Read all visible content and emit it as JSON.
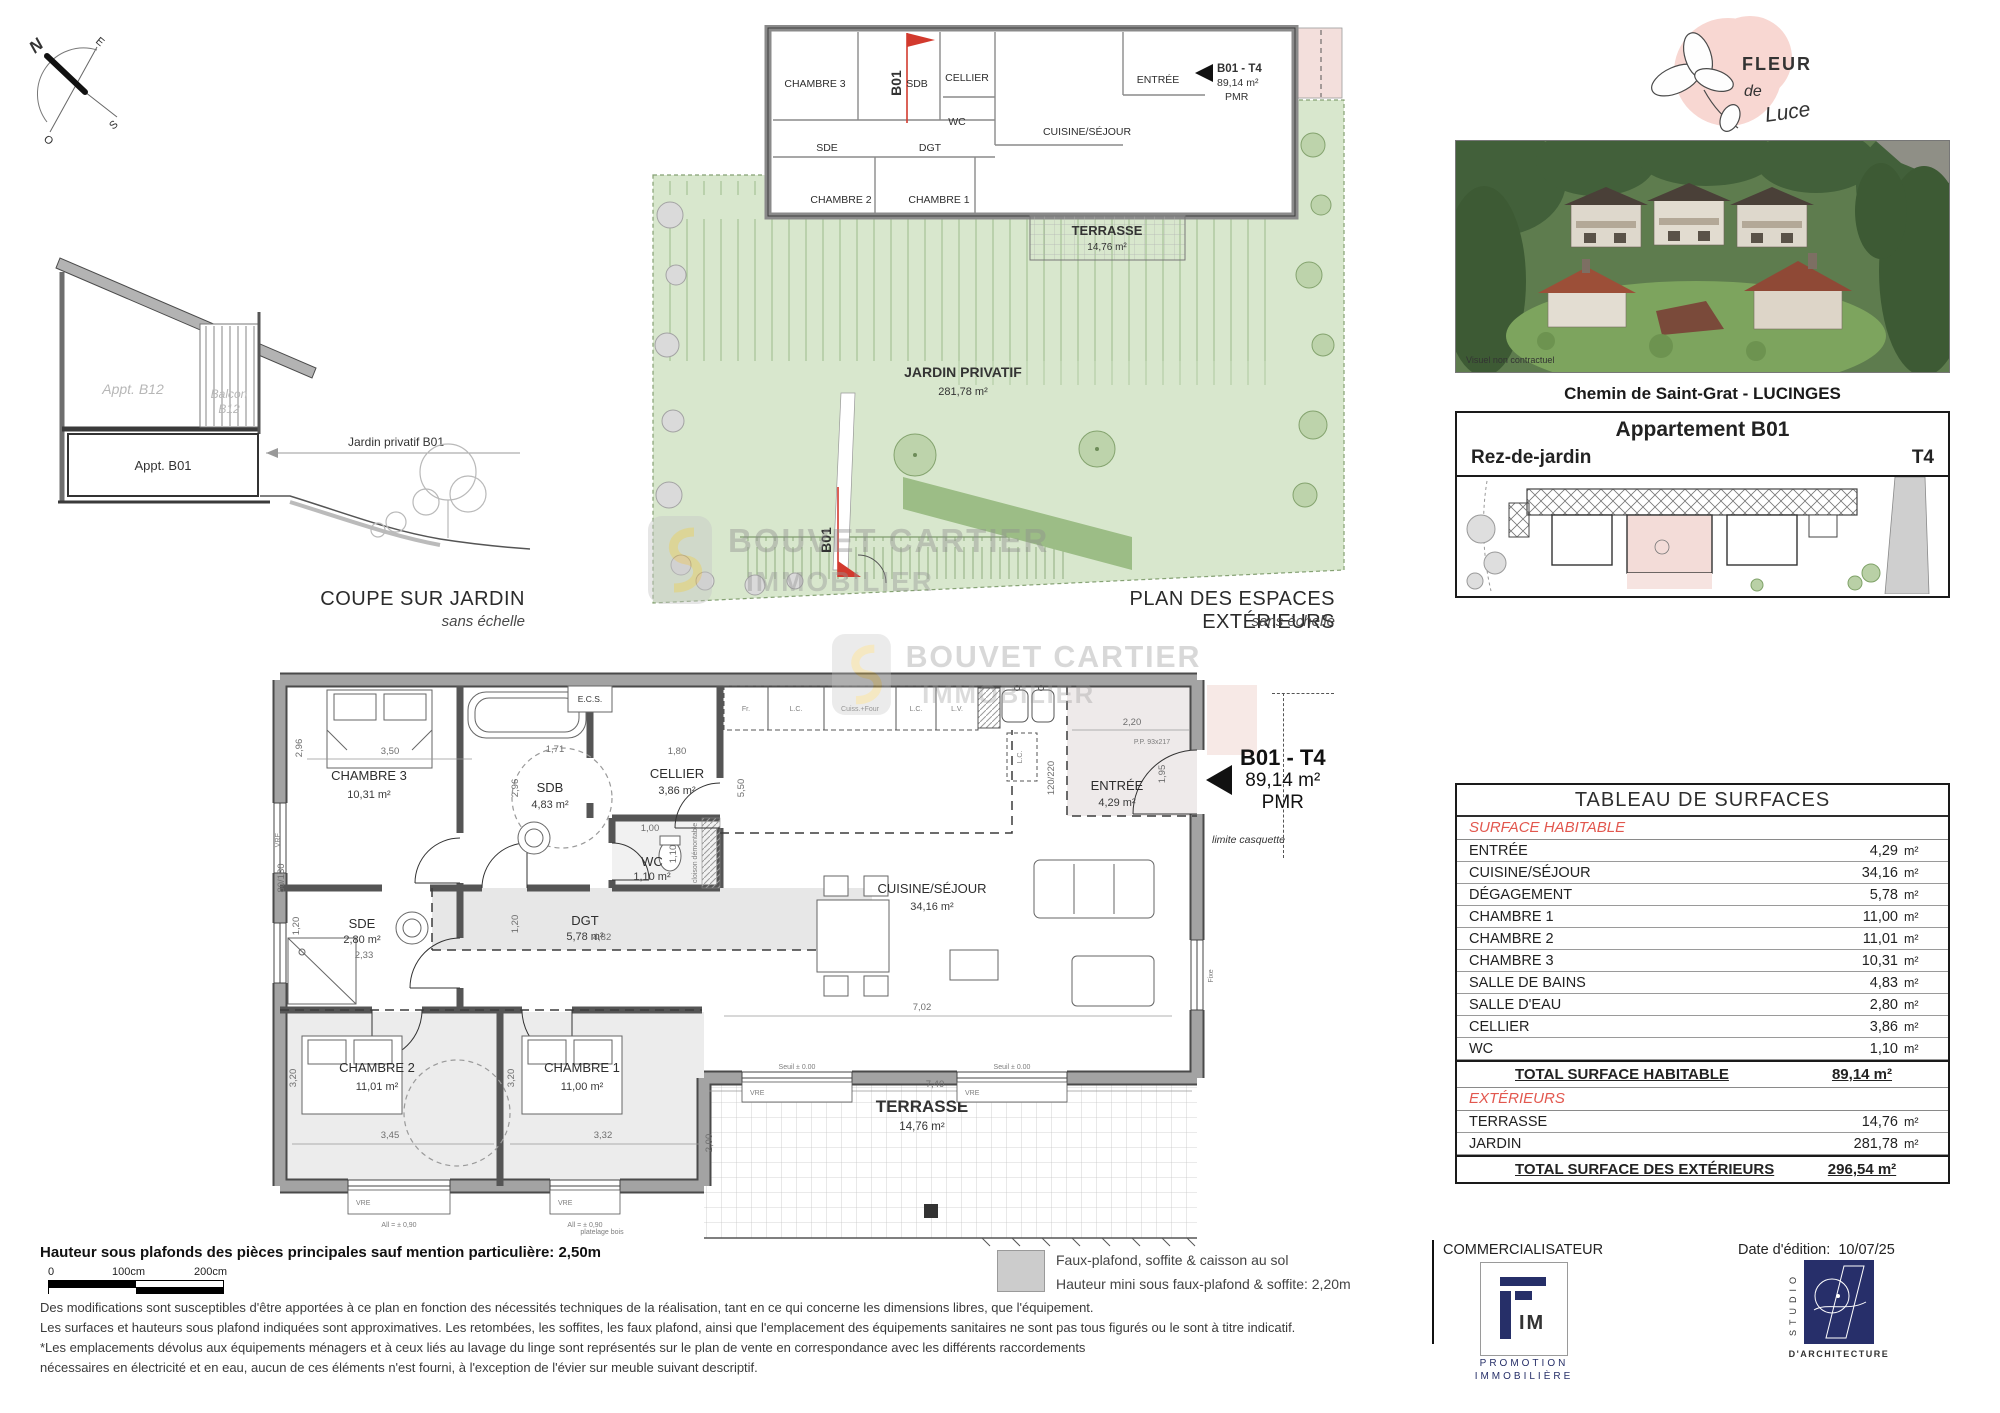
{
  "compass": {
    "n": "N",
    "e": "E",
    "s": "S",
    "o": "O"
  },
  "coupe": {
    "title": "COUPE SUR JARDIN",
    "subtitle": "sans échelle",
    "appt_b12": "Appt. B12",
    "balcon_line1": "Balcon",
    "balcon_line2": "B12",
    "appt_b01": "Appt. B01",
    "jardin_label": "Jardin privatif B01"
  },
  "site_plan": {
    "title": "PLAN DES ESPACES EXTÉRIEURS",
    "subtitle": "sans échelle",
    "jardin_name": "JARDIN PRIVATIF",
    "jardin_area": "281,78 m²",
    "terrasse_name": "TERRASSE",
    "terrasse_area": "14,76 m²",
    "marker": "B01",
    "marker2": "B01",
    "unit_name": "B01 - T4",
    "unit_area": "89,14 m²",
    "unit_pmr": "PMR",
    "rooms": {
      "chambre3": "CHAMBRE 3",
      "sdb": "SDB",
      "cellier": "CELLIER",
      "wc": "WC",
      "entree": "ENTRÉE",
      "cuisine": "CUISINE/SÉJOUR",
      "sde": "SDE",
      "dgt": "DGT",
      "chambre2": "CHAMBRE 2",
      "chambre1": "CHAMBRE 1"
    }
  },
  "floor_plan": {
    "unit_name": "B01 - T4",
    "unit_area": "89,14 m²",
    "unit_pmr": "PMR",
    "limite": "limite casquette",
    "rooms": {
      "chambre3": {
        "name": "CHAMBRE 3",
        "area": "10,31 m²"
      },
      "sdb": {
        "name": "SDB",
        "area": "4,83 m²"
      },
      "cellier": {
        "name": "CELLIER",
        "area": "3,86 m²"
      },
      "wc": {
        "name": "WC",
        "area": "1,10 m²"
      },
      "sde": {
        "name": "SDE",
        "area": "2,80 m²"
      },
      "dgt": {
        "name": "DGT",
        "area": "5,78 m²"
      },
      "chambre2": {
        "name": "CHAMBRE 2",
        "area": "11,01 m²"
      },
      "chambre1": {
        "name": "CHAMBRE 1",
        "area": "11,00 m²"
      },
      "cuisine": {
        "name": "CUISINE/SÉJOUR",
        "area": "34,16 m²"
      },
      "entree": {
        "name": "ENTRÉE",
        "area": "4,29 m²"
      }
    },
    "terrasse": {
      "name": "TERRASSE",
      "area": "14,76 m²"
    },
    "dims": {
      "d350": "3,50",
      "d296": "2,96",
      "d296b": "2,96",
      "d171": "1,71",
      "d180": "1,80",
      "d100": "1,00",
      "d110": "1,10",
      "d233": "2,33",
      "d120": "1,20",
      "d120b": "1,20",
      "d482": "4,82",
      "d345": "3,45",
      "d320": "3,20",
      "d320b": "3,20",
      "d332": "3,32",
      "d550": "5,50",
      "d702": "7,02",
      "d220": "2,20",
      "d195": "1,95",
      "d740": "7,40",
      "d200": "2,00",
      "d8013": "80/130",
      "d120220": "120/220"
    },
    "kitchen": {
      "k1": "Fr.",
      "k2": "L.C.",
      "k3": "Cuiss.+Four",
      "k4": "L.C.",
      "k5": "L.V.",
      "k6": "L.C.",
      "ecs": "E.C.S."
    },
    "small": {
      "vre": "VRE",
      "allib": "All = ± 0,90",
      "seuil": "Seuil ± 0.00",
      "fixe": "Fixe",
      "cloison": "cloison démontable",
      "pp": "P.P. 93x217",
      "platelage": "platelage bois"
    }
  },
  "watermark": {
    "line1": "BOUVET CARTIER",
    "line2": "IMMOBILIER"
  },
  "branding": {
    "logo_line1": "FLEUR",
    "logo_line2": "de",
    "logo_line3": "Luce"
  },
  "photo": {
    "caption": "Visuel non contractuel"
  },
  "address": "Chemin de Saint-Grat - LUCINGES",
  "apartment": {
    "title": "Appartement B01",
    "level": "Rez-de-jardin",
    "type": "T4"
  },
  "surface_table": {
    "title": "TABLEAU DE SURFACES",
    "habitable_header": "SURFACE HABITABLE",
    "habitable_rows": [
      {
        "label": "ENTRÉE",
        "value": "4,29",
        "unit": "m²"
      },
      {
        "label": "CUISINE/SÉJOUR",
        "value": "34,16",
        "unit": "m²"
      },
      {
        "label": "DÉGAGEMENT",
        "value": "5,78",
        "unit": "m²"
      },
      {
        "label": "CHAMBRE 1",
        "value": "11,00",
        "unit": "m²"
      },
      {
        "label": "CHAMBRE 2",
        "value": "11,01",
        "unit": "m²"
      },
      {
        "label": "CHAMBRE 3",
        "value": "10,31",
        "unit": "m²"
      },
      {
        "label": "SALLE DE BAINS",
        "value": "4,83",
        "unit": "m²"
      },
      {
        "label": "SALLE D'EAU",
        "value": "2,80",
        "unit": "m²"
      },
      {
        "label": "CELLIER",
        "value": "3,86",
        "unit": "m²"
      },
      {
        "label": "WC",
        "value": "1,10",
        "unit": "m²"
      }
    ],
    "total_habitable_label": "TOTAL SURFACE HABITABLE",
    "total_habitable_value": "89,14 m²",
    "ext_header": "EXTÉRIEURS",
    "ext_rows": [
      {
        "label": "TERRASSE",
        "value": "14,76",
        "unit": "m²"
      },
      {
        "label": "JARDIN",
        "value": "281,78",
        "unit": "m²"
      }
    ],
    "total_ext_label": "TOTAL SURFACE DES EXTÉRIEURS",
    "total_ext_value": "296,54 m²"
  },
  "notes": {
    "height_note": "Hauteur sous plafonds des pièces principales sauf mention particulière: 2,50m",
    "scale": {
      "s0": "0",
      "s1": "100cm",
      "s2": "200cm"
    },
    "legend_line1": "Faux-plafond, soffite & caisson au sol",
    "legend_line2": "Hauteur mini sous faux-plafond & soffite: 2,20m",
    "para1": "Des modifications sont susceptibles d'être apportées à ce plan en fonction des nécessités techniques de la réalisation, tant en ce qui concerne les dimensions libres, que l'équipement.",
    "para2": "Les surfaces et hauteurs sous plafond indiquées sont approximatives. Les retombées, les soffites, les faux plafond, ainsi que l'emplacement des équipements sanitaires ne sont pas tous figurés ou le sont à titre indicatif.",
    "para3": "*Les emplacements dévolus aux équipements ménagers et à ceux liés au lavage du linge sont représentés sur le plan de vente en correspondance avec les différents raccordements",
    "para4": "nécessaires en électricité et en eau, aucun de ces éléments n'est fourni, à l'exception de l'évier sur meuble suivant descriptif."
  },
  "footer": {
    "commercialisateur": "COMMERCIALISATEUR",
    "date_label": "Date d'édition:",
    "date_value": "10/07/25",
    "fim_im": "IM",
    "fim_line1": "PROMOTION",
    "fim_line2": "IMMOBILIÈRE",
    "studio_vertical": "STUDIO",
    "studio_bottom": "D'ARCHITECTURE"
  }
}
